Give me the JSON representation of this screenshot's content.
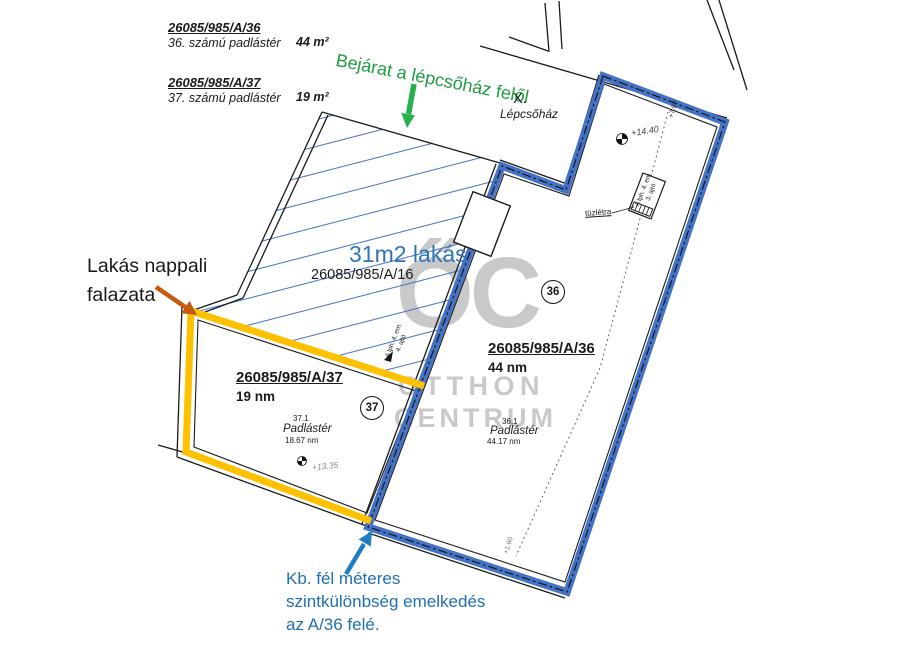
{
  "legend": {
    "p36": {
      "id": "26085/985/A/36",
      "desc": "36. számú padlástér",
      "area": "44 m²"
    },
    "p37": {
      "id": "26085/985/A/37",
      "desc": "37. számú padlástér",
      "area": "19 m²"
    }
  },
  "notes": {
    "entrance": "Bejárat a lépcsőház felől",
    "flat_size": "31m2 lakás",
    "flat_id": "26085/985/A/16",
    "wall1": "Lakás nappali",
    "wall2": "falazata",
    "level1": "Kb. fél méteres",
    "level2": "szintkülönbség emelkedés",
    "level3": "az A/36 felé."
  },
  "plan": {
    "stair_x": "X.",
    "stair_name": "Lépcsőház",
    "p37": {
      "id": "26085/985/A/37",
      "area": "19 nm",
      "num": "37",
      "room": "37.1",
      "type": "Padlástér",
      "size": "18.67 nm",
      "level": "+13.35"
    },
    "p36": {
      "id": "26085/985/A/36",
      "area": "44 nm",
      "num": "36",
      "room": "36.1",
      "type": "Padlástér",
      "size": "44.17 nm",
      "level_top": "+14.40",
      "level_line_top": "+7.92",
      "level_line_bottom": "+1.60"
    },
    "door36_l1": "A lph. 4. em.",
    "door36_l2": "3. ajtó",
    "door16_l1": "A lph. 4. em.",
    "door16_l2": "4. ajtó",
    "ladder": "tüzlétra"
  },
  "watermark": {
    "glyphs": "ŐC",
    "l1": "OTTHON",
    "l2": "CENTRUM"
  },
  "colors": {
    "wall_36": "#4472C4",
    "wall_37": "#FFC000",
    "hatch": "#4472C4",
    "entrance_green": "#1E9C40",
    "wall_note_orange": "#C55A11",
    "level_note_blue": "#1F6EB4",
    "flat_label_blue": "#2E75B6",
    "watermark_gray": "#C9C9C9"
  }
}
